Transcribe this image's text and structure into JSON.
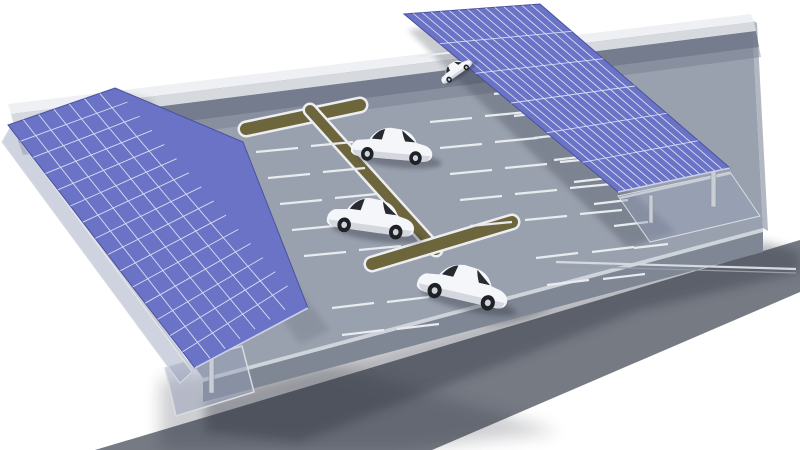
{
  "scene": {
    "title": "3D rendering of a parking lot with two rooftop solar panel carport canopies, four white cars and an access road",
    "background": "#ffffff",
    "palette": {
      "lot": "#9aa1ae",
      "curb": "#cfd4db",
      "skirt": "#7f8694",
      "skirt_right": "#b2b8c2",
      "wall_top": "#eef0f3",
      "wall_face": "#d6dade",
      "wall_shadow": "#6d7688",
      "road": "#757a83",
      "shadow": "#262c38",
      "panel": "#6a73c5",
      "panel_edge": "#4a529e",
      "panel_grid": "#dfe3f5",
      "panel_light_edge": "#ccd0e8",
      "median": "#6d663c",
      "median_edge": "#eceef2",
      "stall_line": "#e8ebef",
      "structure": "#c9ced6",
      "structure_dark": "#8e95a0",
      "rail_light": "#d6dae0",
      "rail_dark": "#979eaa",
      "glass": "rgba(148,158,184,0.45)",
      "glass_edge": "#d8dce2",
      "car_body": "#f4f6f9",
      "car_shade": "#c6cbd3",
      "car_window": "#15181d",
      "car_wheel": "#1e2126",
      "car_hub": "#cfd3da"
    },
    "road": {
      "points": "95,450 800,240 800,292 432,450",
      "shadow_points": "205,400 763,242 800,252 800,272 640,310 300,442 205,432",
      "corner_shadow_points": "160,380 320,360 560,432 400,450 160,450",
      "car_shadow": {
        "cx": 515,
        "cy": 312,
        "rx": 40,
        "ry": 9,
        "rotate": -14
      }
    },
    "platform": {
      "lot": "15,112 752,20 763,228 203,378",
      "curb": "203,374 763,224 763,232 203,382",
      "skirt_front": "203,380 763,230 763,252 203,402",
      "skirt_right": "752,20 763,228 768,231 757,23",
      "wall_top": "8,104 751,14 754,22 11,114",
      "wall_face": "11,114 754,22 756,31 14,125",
      "wall_shadow": "14,125 756,31 759,47 19,143",
      "wall_shadow2": "19,143 759,47 761,57 23,155"
    },
    "canopies": [
      {
        "name": "solar-canopy-left",
        "outline": "115,88 243,142 308,308 195,368 8,125",
        "grid_quad": [
          [
            115,
            88
          ],
          [
            300,
            300
          ],
          [
            195,
            368
          ],
          [
            8,
            125
          ]
        ],
        "cells_long": 15,
        "cells_across": 7,
        "shadow_points": "118,92 150,98 330,330 300,344",
        "shadow_opacity": 0.12,
        "light_edge": [
          [
            195,
            368
          ],
          [
            308,
            308
          ]
        ],
        "glass": "10,128 192,372 180,383 2,142",
        "beam": [
          [
            16,
            132
          ],
          [
            196,
            374
          ]
        ],
        "posts": [
          [
            209,
            349,
            5,
            44
          ]
        ]
      },
      {
        "name": "solar-canopy-right",
        "outline": "404,14 540,4 730,168 618,192",
        "grid_quad": [
          [
            404,
            14
          ],
          [
            540,
            4
          ],
          [
            730,
            168
          ],
          [
            618,
            192
          ]
        ],
        "cells_long": 15,
        "cells_across": 6,
        "shadow_points": "408,30 452,24 676,232 628,248",
        "shadow_opacity": 0.24,
        "light_edge": [
          [
            618,
            192
          ],
          [
            730,
            168
          ]
        ],
        "glass": "618,196 730,172 760,216 650,242",
        "beam": [
          [
            620,
            198
          ],
          [
            731,
            173
          ]
        ],
        "posts": [
          [
            711,
            171,
            5,
            36
          ],
          [
            649,
            195,
            4,
            28
          ]
        ]
      }
    ],
    "medians": [
      {
        "name": "median-island-top",
        "x1": 246,
        "y1": 129,
        "x2": 360,
        "y2": 105,
        "w": 12
      },
      {
        "name": "median-spine",
        "x1": 310,
        "y1": 110,
        "x2": 436,
        "y2": 250,
        "w": 10
      },
      {
        "name": "median-island-bottom",
        "x1": 372,
        "y1": 264,
        "x2": 512,
        "y2": 222,
        "w": 12
      }
    ],
    "stall_groups": [
      {
        "name": "stalls-left-field",
        "base": [
          256,
          152
        ],
        "dash": [
          42,
          -4
        ],
        "per_row": 2,
        "dash_step": [
          55,
          -6
        ],
        "rows": 5,
        "row_step": [
          12,
          26
        ]
      },
      {
        "name": "stalls-right-field",
        "base": [
          430,
          122
        ],
        "dash": [
          42,
          -4
        ],
        "per_row": 3,
        "dash_step": [
          55,
          -6
        ],
        "rows": 5,
        "row_step": [
          10,
          26
        ]
      },
      {
        "name": "stalls-top-row",
        "base": [
          418,
          56
        ],
        "dash": [
          38,
          -4
        ],
        "per_row": 2,
        "dash_step": [
          50,
          -5
        ],
        "rows": 1,
        "row_step": [
          0,
          0
        ]
      },
      {
        "name": "stalls-bottom-right",
        "base": [
          536,
          258
        ],
        "dash": [
          42,
          -5
        ],
        "per_row": 2,
        "dash_step": [
          56,
          -6
        ],
        "rows": 2,
        "row_step": [
          11,
          27
        ]
      },
      {
        "name": "stalls-bottom-left",
        "base": [
          332,
          308
        ],
        "dash": [
          42,
          -5
        ],
        "per_row": 2,
        "dash_step": [
          55,
          -6
        ],
        "rows": 2,
        "row_step": [
          10,
          27
        ]
      },
      {
        "name": "stalls-right-canopy-column",
        "base": [
          474,
          72
        ],
        "dash": [
          34,
          -4
        ],
        "per_row": 1,
        "dash_step": [
          0,
          0
        ],
        "rows": 9,
        "row_step": [
          20,
          22
        ]
      }
    ],
    "structures": {
      "rails": [
        {
          "x1": 556,
          "y1": 262,
          "x2": 796,
          "y2": 269,
          "color": "rail_light",
          "w": 2.2
        },
        {
          "x1": 556,
          "y1": 266,
          "x2": 796,
          "y2": 273,
          "color": "rail_dark",
          "w": 1.2
        }
      ],
      "corner_glass": "165,368 242,346 254,392 176,416"
    },
    "cars": [
      {
        "name": "car-parked-top",
        "x": 456,
        "y": 71,
        "scale": 0.34,
        "rotate": -35
      },
      {
        "name": "car-driving-1",
        "x": 392,
        "y": 149,
        "scale": 0.78,
        "rotate": 5
      },
      {
        "name": "car-driving-2",
        "x": 371,
        "y": 221,
        "scale": 0.84,
        "rotate": 8
      },
      {
        "name": "car-exiting",
        "x": 463,
        "y": 289,
        "scale": 0.88,
        "rotate": 13
      }
    ],
    "counts": {
      "cars": 4,
      "solar_canopies": 2,
      "median_islands": 3
    }
  }
}
